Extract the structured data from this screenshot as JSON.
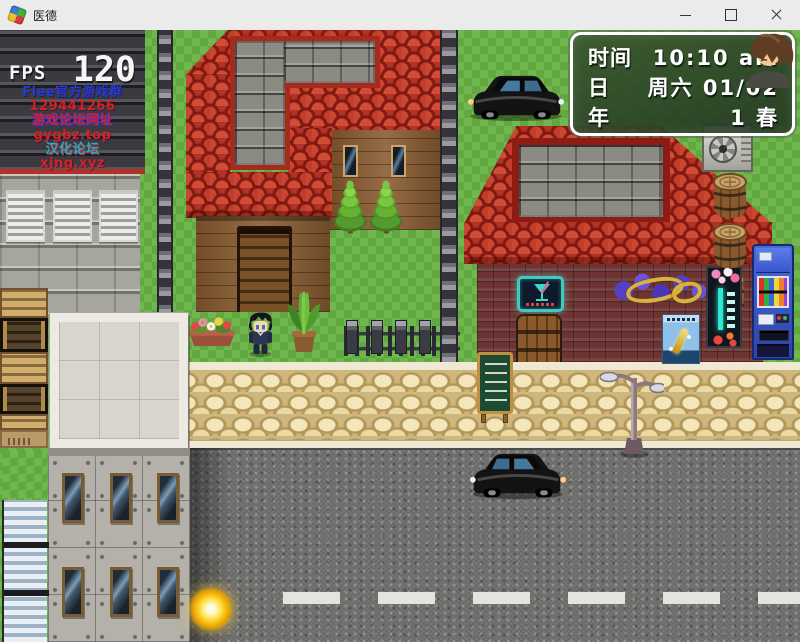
{
  "window": {
    "title": "医德"
  },
  "hud": {
    "fps_label": "FPS",
    "fps_value": "120",
    "links": [
      {
        "text": "Fiee官方游戏群"
      },
      {
        "text": "129441266"
      },
      {
        "text": "游戏论坛网址"
      },
      {
        "text": "gygbz.top"
      },
      {
        "text": "汉化论坛"
      },
      {
        "text": "xjng.xyz"
      }
    ]
  },
  "info_panel": {
    "rows": [
      {
        "label": "时间",
        "value": "10:10 am"
      },
      {
        "label": "日",
        "value": "周六 01/02"
      },
      {
        "label": "年",
        "value": "1 春"
      }
    ]
  },
  "colors": {
    "titlebar": "#ebebeb",
    "grass": "#68b244",
    "roof_red": "#b23226",
    "link_blue": "#2836da",
    "link_red": "#d62222",
    "link_cyan": "#2ba6c8",
    "panel_border": "#ffffff",
    "road": "#6f6f6d"
  }
}
